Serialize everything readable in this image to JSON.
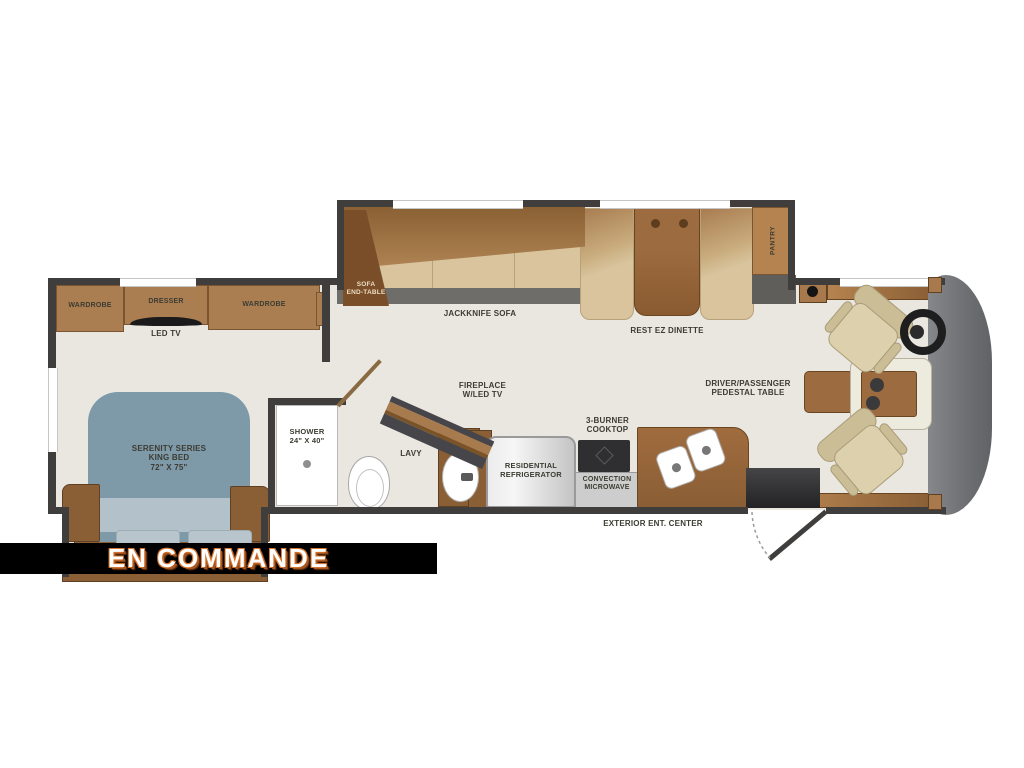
{
  "banner": {
    "text": "EN COMMANDE",
    "bg_color": "#000000",
    "text_color": "#fdfdfd",
    "accent_color": "#d4742e"
  },
  "labels": {
    "wardrobe_left": "WARDROBE",
    "dresser": "DRESSER",
    "led_tv": "LED TV",
    "wardrobe_right": "WARDROBE",
    "bed": [
      "SERENITY SERIES",
      "KING BED",
      "72\" X 75\""
    ],
    "shower": [
      "SHOWER",
      "24\" X 40\""
    ],
    "lavy": "LAVY",
    "fireplace": [
      "FIREPLACE",
      "W/LED TV"
    ],
    "refrigerator": [
      "RESIDENTIAL",
      "REFRIGERATOR"
    ],
    "cooktop": [
      "3-BURNER",
      "COOKTOP"
    ],
    "microwave": [
      "CONVECTION",
      "MICROWAVE"
    ],
    "exterior_center": "EXTERIOR ENT. CENTER",
    "sofa_end_table": [
      "SOFA",
      "END-TABLE"
    ],
    "jackknife_sofa": "JACKKNIFE SOFA",
    "dinette": "REST EZ DINETTE",
    "pantry": "PANTRY",
    "pedestal_table": [
      "DRIVER/PASSENGER",
      "PEDESTAL TABLE"
    ]
  },
  "colors": {
    "floor": "#eae7e1",
    "wall": "#3f3e3c",
    "cabinet_wood": "#ab7e52",
    "dark_wood": "#8a5f35",
    "sofa_tan": "#d9c49e",
    "bed_blue": "#7e99a8",
    "front_cap_gray": "#6f7174",
    "banner_black": "#000000",
    "banner_orange": "#d4742e"
  }
}
